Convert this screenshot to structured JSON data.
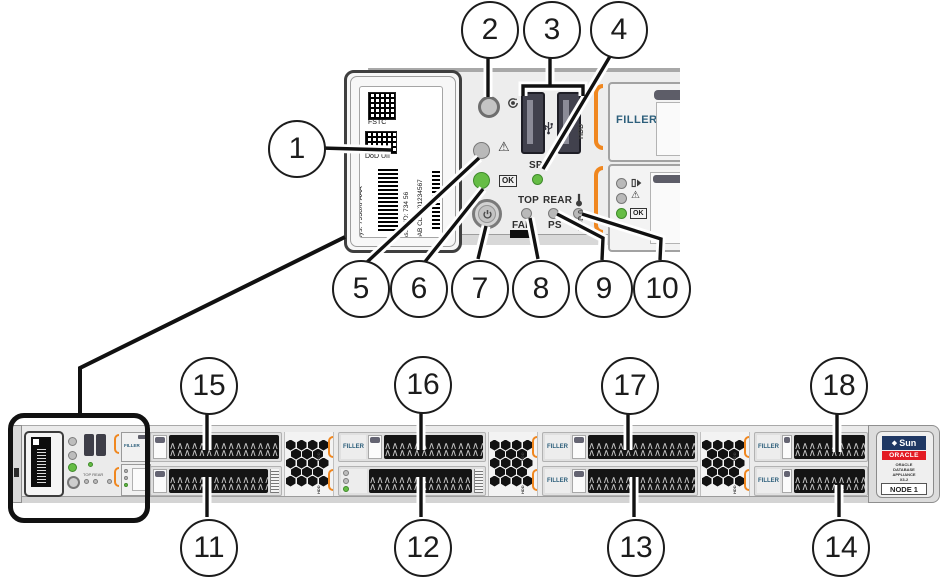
{
  "callouts": {
    "c1": "1",
    "c2": "2",
    "c3": "3",
    "c4": "4",
    "c5": "5",
    "c6": "6",
    "c7": "7",
    "c8": "8",
    "c9": "9",
    "c10": "10",
    "c11": "11",
    "c12": "12",
    "c13": "13",
    "c14": "14",
    "c15": "15",
    "c16": "16",
    "c17": "17",
    "c18": "18"
  },
  "label_tab": {
    "fstc": "FSTC",
    "dod_uii": "DoD UII",
    "sys": "Sys: 7938XFAAA",
    "asset_id": "Asset ID: 734 56",
    "asset_uii": "9AB CDEF01234567"
  },
  "control_panel": {
    "sp": "SP",
    "ok": "OK",
    "top": "TOP",
    "fan": "FAN",
    "rear": "REAR",
    "ps": "PS",
    "hdd_bracket": "HDD",
    "hdd0_bracket": "HDD 0",
    "filler": "FILLER"
  },
  "drive_bays": {
    "filler": "FILLER",
    "vent_bracket": "HDD"
  },
  "endcap": {
    "sun": "Sun",
    "oracle": "ORACLE",
    "product_line1": "ORACLE",
    "product_line2": "DATABASE",
    "product_line3": "APPLIANCE",
    "product_line4": "X3-2",
    "node": "NODE 1"
  },
  "icons": {
    "warning": "⚠",
    "sun_diamond": "◆"
  },
  "colors": {
    "accent_orange": "#F0871F",
    "led_green": "#66BD45",
    "filler_text": "#2D5F7B",
    "sun_navy": "#1F3864",
    "oracle_red": "#E31B23",
    "handle_black": "#141414",
    "chassis_gray": "#ECECEC"
  }
}
